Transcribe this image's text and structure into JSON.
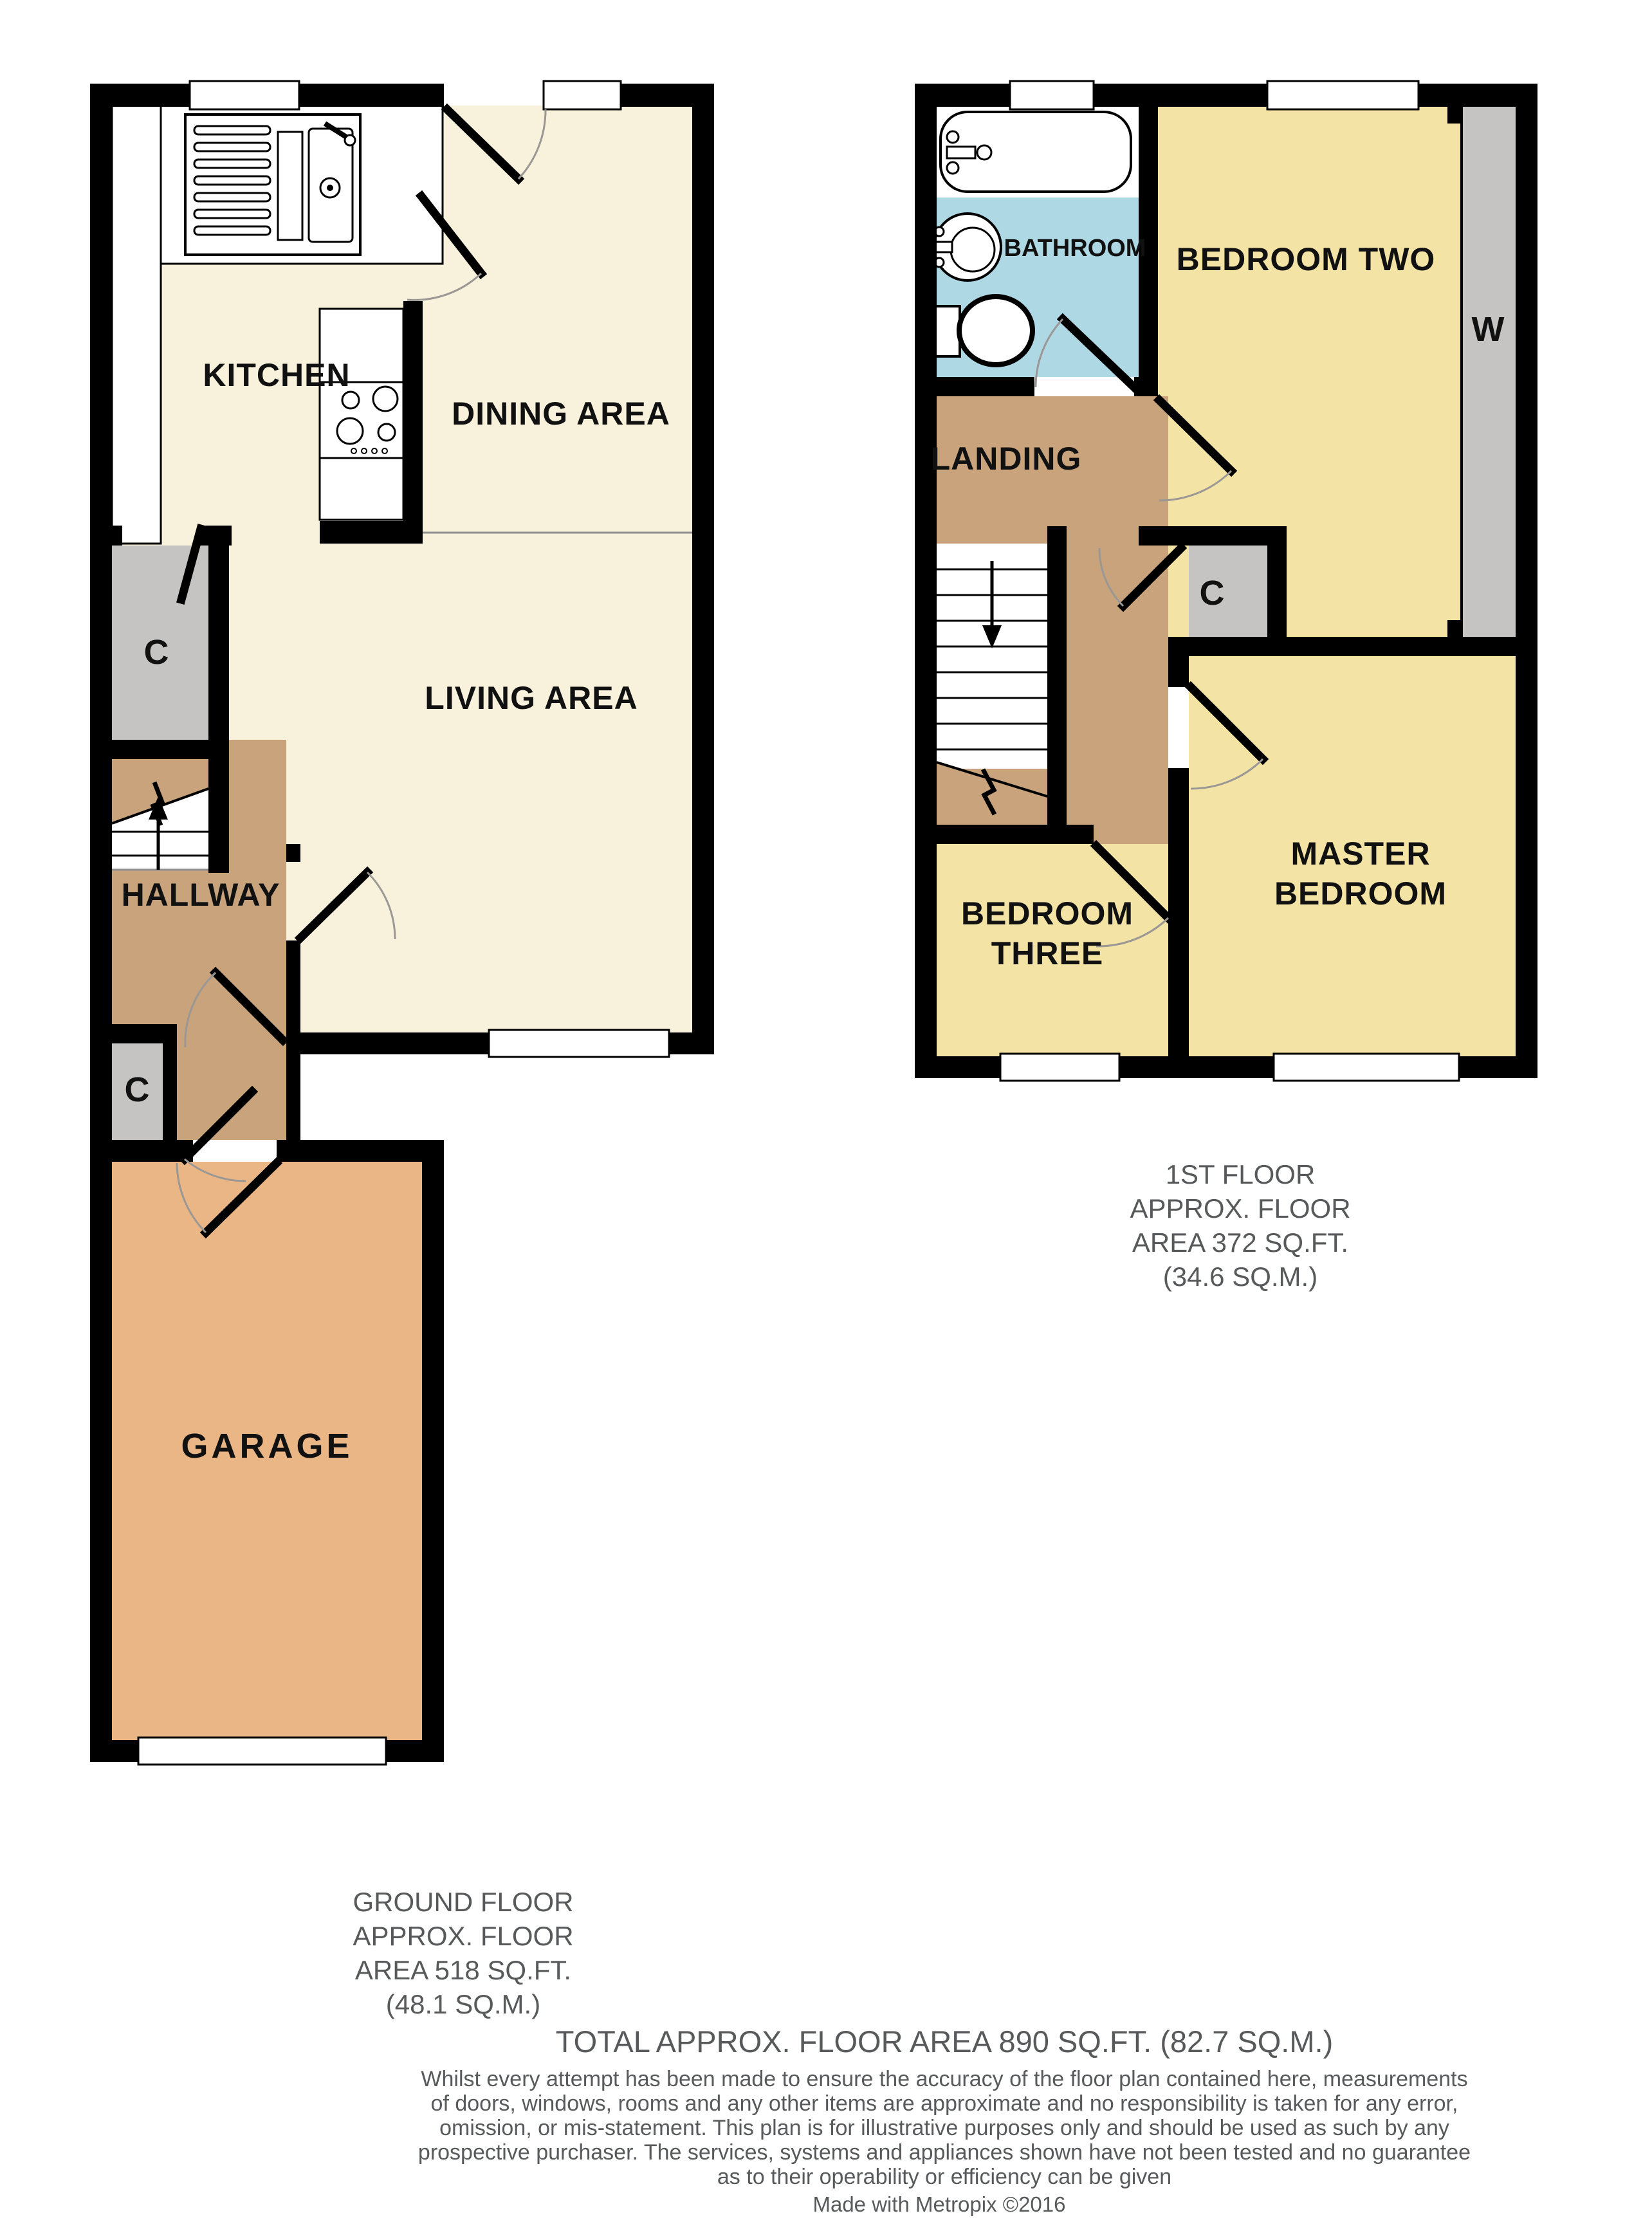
{
  "colors": {
    "wall": "#000000",
    "cream": "#F8F1DB",
    "yellow": "#F3E3A5",
    "tan": "#C8A37C",
    "orange": "#EAB685",
    "gray": "#C5C4C3",
    "blue": "#AFD8E5",
    "arc": "#9A9795",
    "caption": "#58595B"
  },
  "ground_floor": {
    "rooms": {
      "kitchen": "KITCHEN",
      "dining": "DINING AREA",
      "living": "LIVING AREA",
      "hallway": "HALLWAY",
      "closet_upper": "C",
      "closet_lower": "C",
      "garage": "GARAGE"
    },
    "caption_lines": [
      "GROUND FLOOR",
      "APPROX. FLOOR",
      "AREA 518 SQ.FT.",
      "(48.1 SQ.M.)"
    ]
  },
  "first_floor": {
    "rooms": {
      "bathroom": "BATHROOM",
      "bedroom_two": "BEDROOM TWO",
      "wardrobe": "W",
      "landing": "LANDING",
      "closet": "C",
      "master_line1": "MASTER",
      "master_line2": "BEDROOM",
      "bedroom_three_line1": "BEDROOM",
      "bedroom_three_line2": "THREE"
    },
    "caption_lines": [
      "1ST FLOOR",
      "APPROX. FLOOR",
      "AREA 372 SQ.FT.",
      "(34.6 SQ.M.)"
    ]
  },
  "footer": {
    "total_line": "TOTAL APPROX. FLOOR AREA 890 SQ.FT. (82.7 SQ.M.)",
    "disclaimer_lines": [
      "Whilst every attempt has been made to ensure the accuracy of the floor plan contained here, measurements",
      "of doors, windows, rooms and any other items are approximate and no responsibility is taken for any error,",
      "omission, or mis-statement. This plan is for illustrative purposes only and should be used as such by any",
      "prospective purchaser. The services, systems and appliances shown have not been tested and no guarantee",
      "as to their operability or efficiency can be given"
    ],
    "credit": "Made with Metropix ©2016"
  }
}
